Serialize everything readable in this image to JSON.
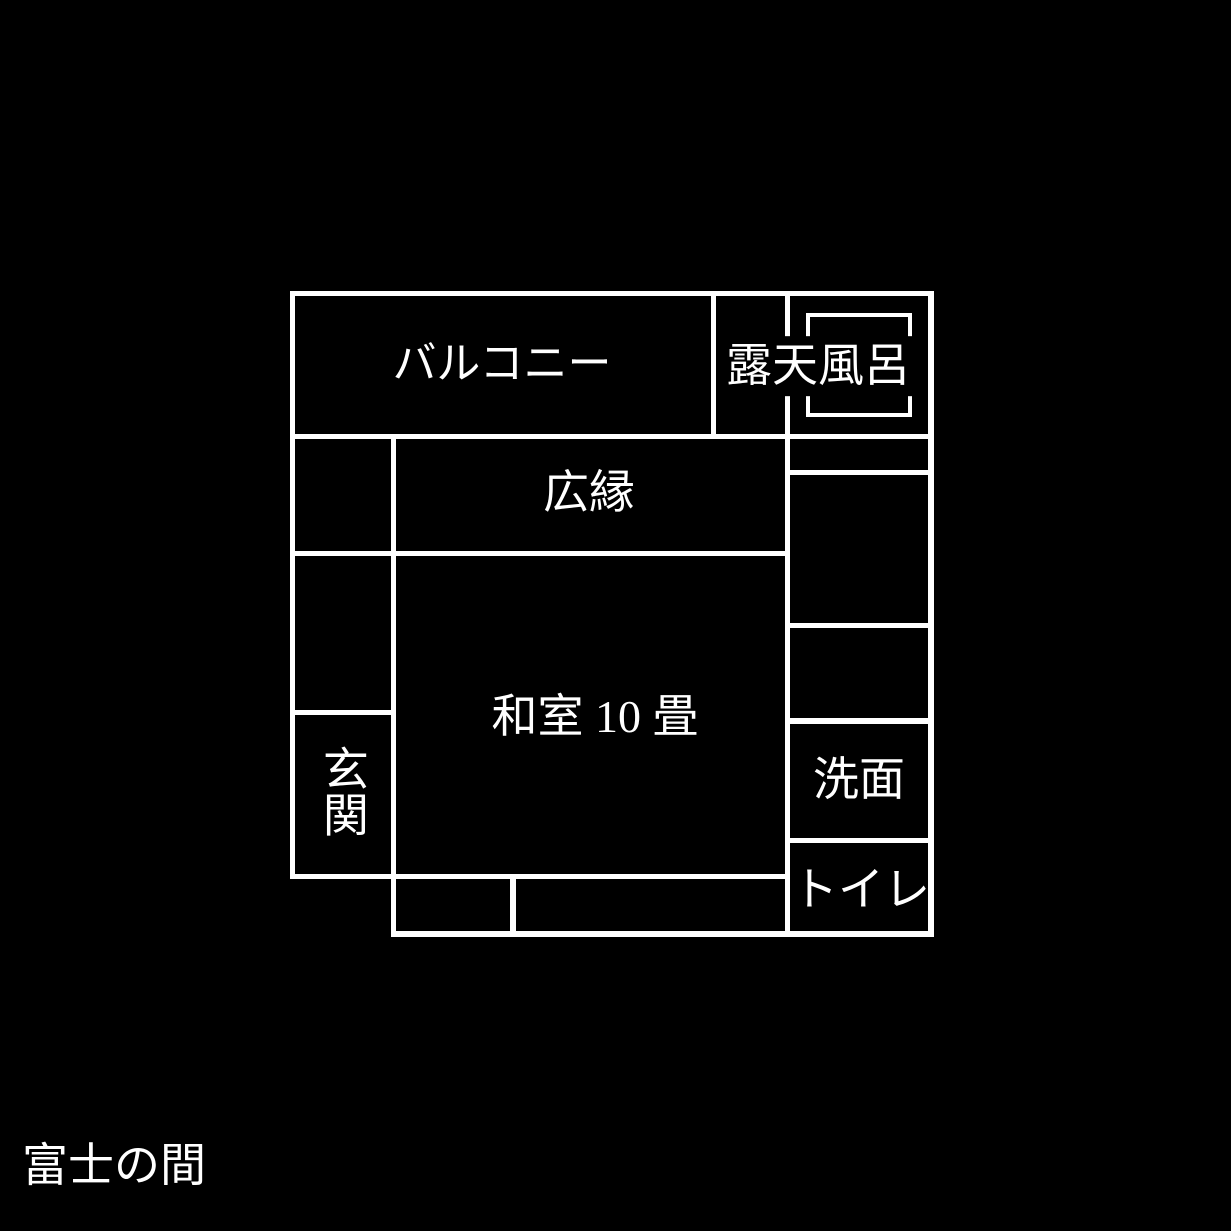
{
  "page": {
    "background_color": "#000000",
    "wall_color": "#ffffff",
    "text_color": "#ffffff"
  },
  "floorplan": {
    "title": "富士の間",
    "walls": [
      {
        "name": "top-border",
        "x": 290,
        "y": 291,
        "w": 644,
        "h": 5
      },
      {
        "name": "left-border",
        "x": 290,
        "y": 291,
        "w": 5,
        "h": 588
      },
      {
        "name": "right-border",
        "x": 928,
        "y": 291,
        "w": 6,
        "h": 646
      },
      {
        "name": "bottom-border",
        "x": 391,
        "y": 931,
        "w": 543,
        "h": 6
      },
      {
        "name": "balcony-right-wall",
        "x": 711,
        "y": 291,
        "w": 5,
        "h": 148
      },
      {
        "name": "right-column-left-wall",
        "x": 785,
        "y": 291,
        "w": 5,
        "h": 646
      },
      {
        "name": "row1-bottom-wall",
        "x": 290,
        "y": 434,
        "w": 644,
        "h": 5
      },
      {
        "name": "left-column-right-wall",
        "x": 391,
        "y": 434,
        "w": 5,
        "h": 503
      },
      {
        "name": "veranda-bottom-wall",
        "x": 290,
        "y": 551,
        "w": 500,
        "h": 5
      },
      {
        "name": "entrance-top-wall",
        "x": 290,
        "y": 710,
        "w": 106,
        "h": 5
      },
      {
        "name": "washitsu-bottom-wall",
        "x": 290,
        "y": 874,
        "w": 500,
        "h": 5
      },
      {
        "name": "bottom-strip-divider",
        "x": 510,
        "y": 876,
        "w": 6,
        "h": 60
      },
      {
        "name": "bath-strip-bottom-wall",
        "x": 785,
        "y": 470,
        "w": 149,
        "h": 5
      },
      {
        "name": "right-column-divider",
        "x": 785,
        "y": 623,
        "w": 149,
        "h": 5
      },
      {
        "name": "washroom-top-wall",
        "x": 785,
        "y": 718,
        "w": 149,
        "h": 6
      },
      {
        "name": "washroom-bottom-wall",
        "x": 785,
        "y": 838,
        "w": 149,
        "h": 5
      }
    ],
    "bathtub": {
      "x": 806,
      "y": 313,
      "w": 106,
      "h": 104
    },
    "labels": [
      {
        "room": "balcony",
        "text": "バルコニー",
        "cx": 502,
        "cy": 364,
        "fs": 44,
        "vertical": false,
        "opaque": false
      },
      {
        "room": "open-air-bath",
        "text": "露天風呂",
        "cx": 818,
        "cy": 366,
        "fs": 46,
        "vertical": false,
        "opaque": true
      },
      {
        "room": "veranda",
        "text": "広縁",
        "cx": 589,
        "cy": 493,
        "fs": 46,
        "vertical": false,
        "opaque": false
      },
      {
        "room": "japanese-room",
        "text": "和室 10 畳",
        "cx": 595,
        "cy": 717,
        "fs": 46,
        "vertical": false,
        "opaque": false
      },
      {
        "room": "entrance",
        "text": "玄関",
        "cx": 342,
        "cy": 791,
        "fs": 46,
        "vertical": true,
        "opaque": false
      },
      {
        "room": "washroom",
        "text": "洗面",
        "cx": 859,
        "cy": 780,
        "fs": 46,
        "vertical": false,
        "opaque": false
      },
      {
        "room": "toilet",
        "text": "トイレ",
        "cx": 861,
        "cy": 890,
        "fs": 46,
        "vertical": false,
        "opaque": false
      },
      {
        "room": "plan-title",
        "text": "富士の間",
        "cx": 114,
        "cy": 1166,
        "fs": 46,
        "vertical": false,
        "opaque": false
      }
    ]
  }
}
